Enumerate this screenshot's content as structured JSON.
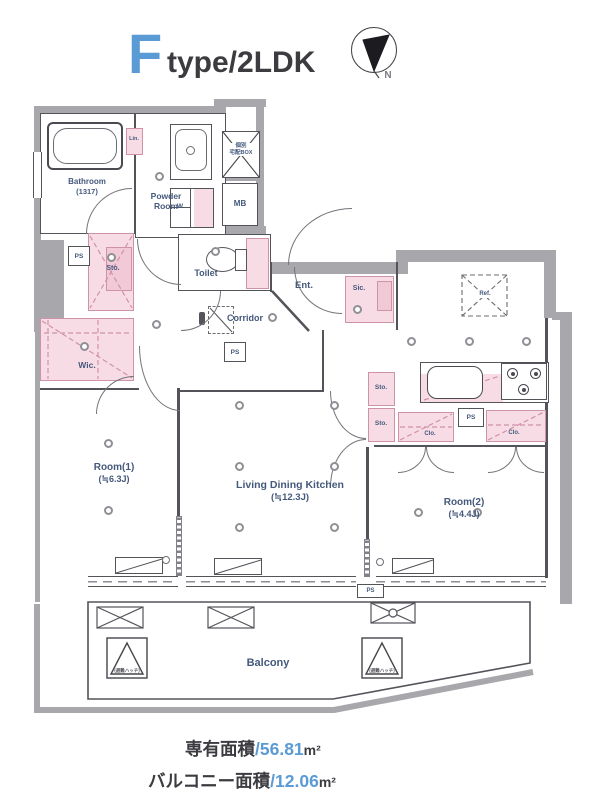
{
  "title": {
    "letter": "F",
    "rest": "type/2LDK"
  },
  "compass": {
    "north": "N"
  },
  "labels": {
    "bathroom": "Bathroom",
    "bathroom_size": "(1317)",
    "powder1": "Powder",
    "powder2": "Room",
    "lin": "Lin.",
    "mb": "MB",
    "delivery1": "個別",
    "delivery2": "宅配BOX",
    "ps": "PS",
    "sto": "Sto.",
    "wic": "Wic.",
    "toilet": "Toilet",
    "corridor": "Corridor",
    "ent": "Ent.",
    "sic": "Sic.",
    "ref": "Ref.",
    "washer": "W",
    "clo": "Clo.",
    "room1": "Room(1)",
    "room1_size": "(≒6.3J)",
    "ldk": "Living Dining Kitchen",
    "ldk_size": "(≒12.3J)",
    "room2": "Room(2)",
    "room2_size": "(≒4.4J)",
    "balcony": "Balcony",
    "hatch": "(避難ハッチ)"
  },
  "areas": {
    "exclusive_label": "専有面積",
    "exclusive_value": "/56.81",
    "exclusive_unit": "m²",
    "balcony_label": "バルコニー面積",
    "balcony_value": "/12.06",
    "balcony_unit": "m²"
  },
  "colors": {
    "accent_blue": "#5b9bd5",
    "pink_fill": "#f8dce5",
    "wall_gray": "#a8a7ab",
    "label_blue": "#44597c"
  }
}
